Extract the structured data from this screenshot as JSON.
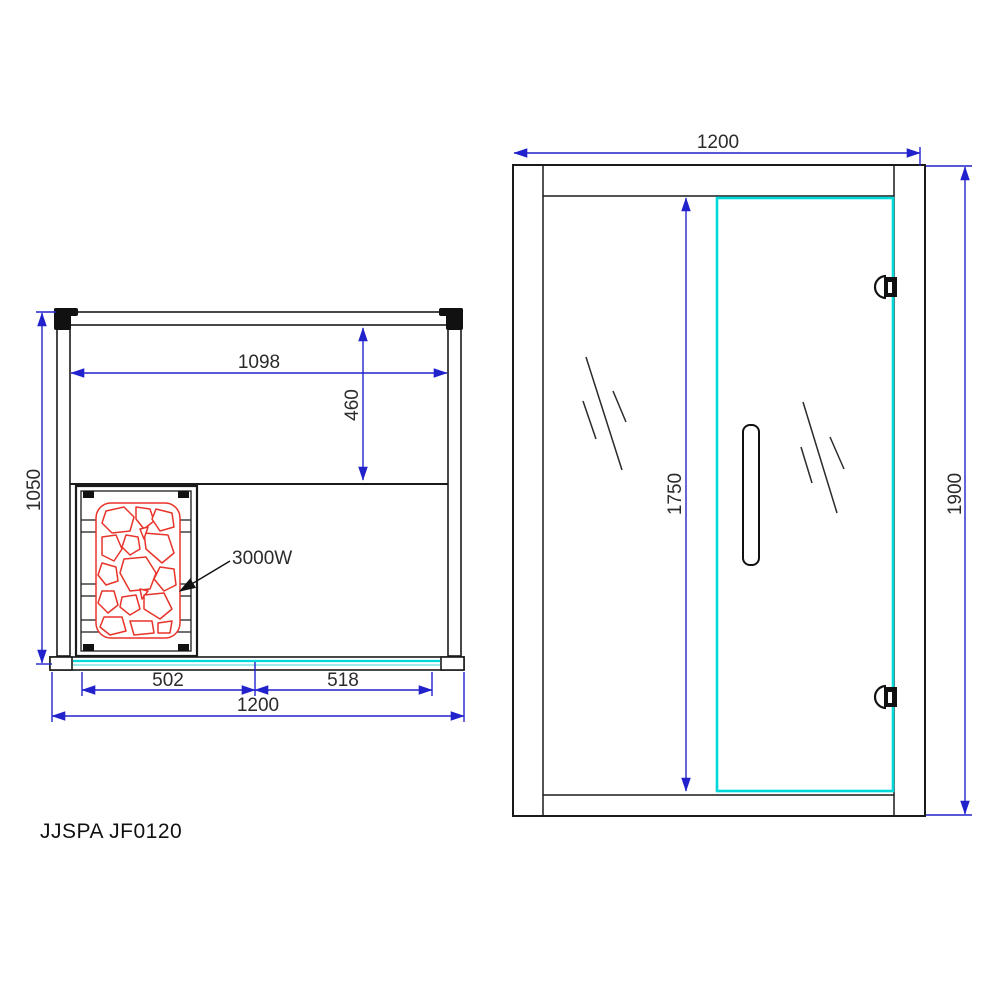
{
  "meta": {
    "model": "JJSPA JF0120"
  },
  "plan_view": {
    "dim_interior_width": "1098",
    "dim_bench_depth": "460",
    "dim_depth": "1050",
    "dim_front_left_panel": "502",
    "dim_front_door": "518",
    "dim_overall_width": "1200",
    "heater_power": "3000W"
  },
  "front_view": {
    "dim_overall_width": "1200",
    "dim_glass_height": "1750",
    "dim_overall_height": "1900"
  },
  "colors": {
    "dimension_blue": "#2222cc",
    "glass_cyan": "#00d9d9",
    "glass_cyan_light": "#9feaea",
    "heater_red": "#e8342a",
    "line_black": "#1a1a1a"
  }
}
